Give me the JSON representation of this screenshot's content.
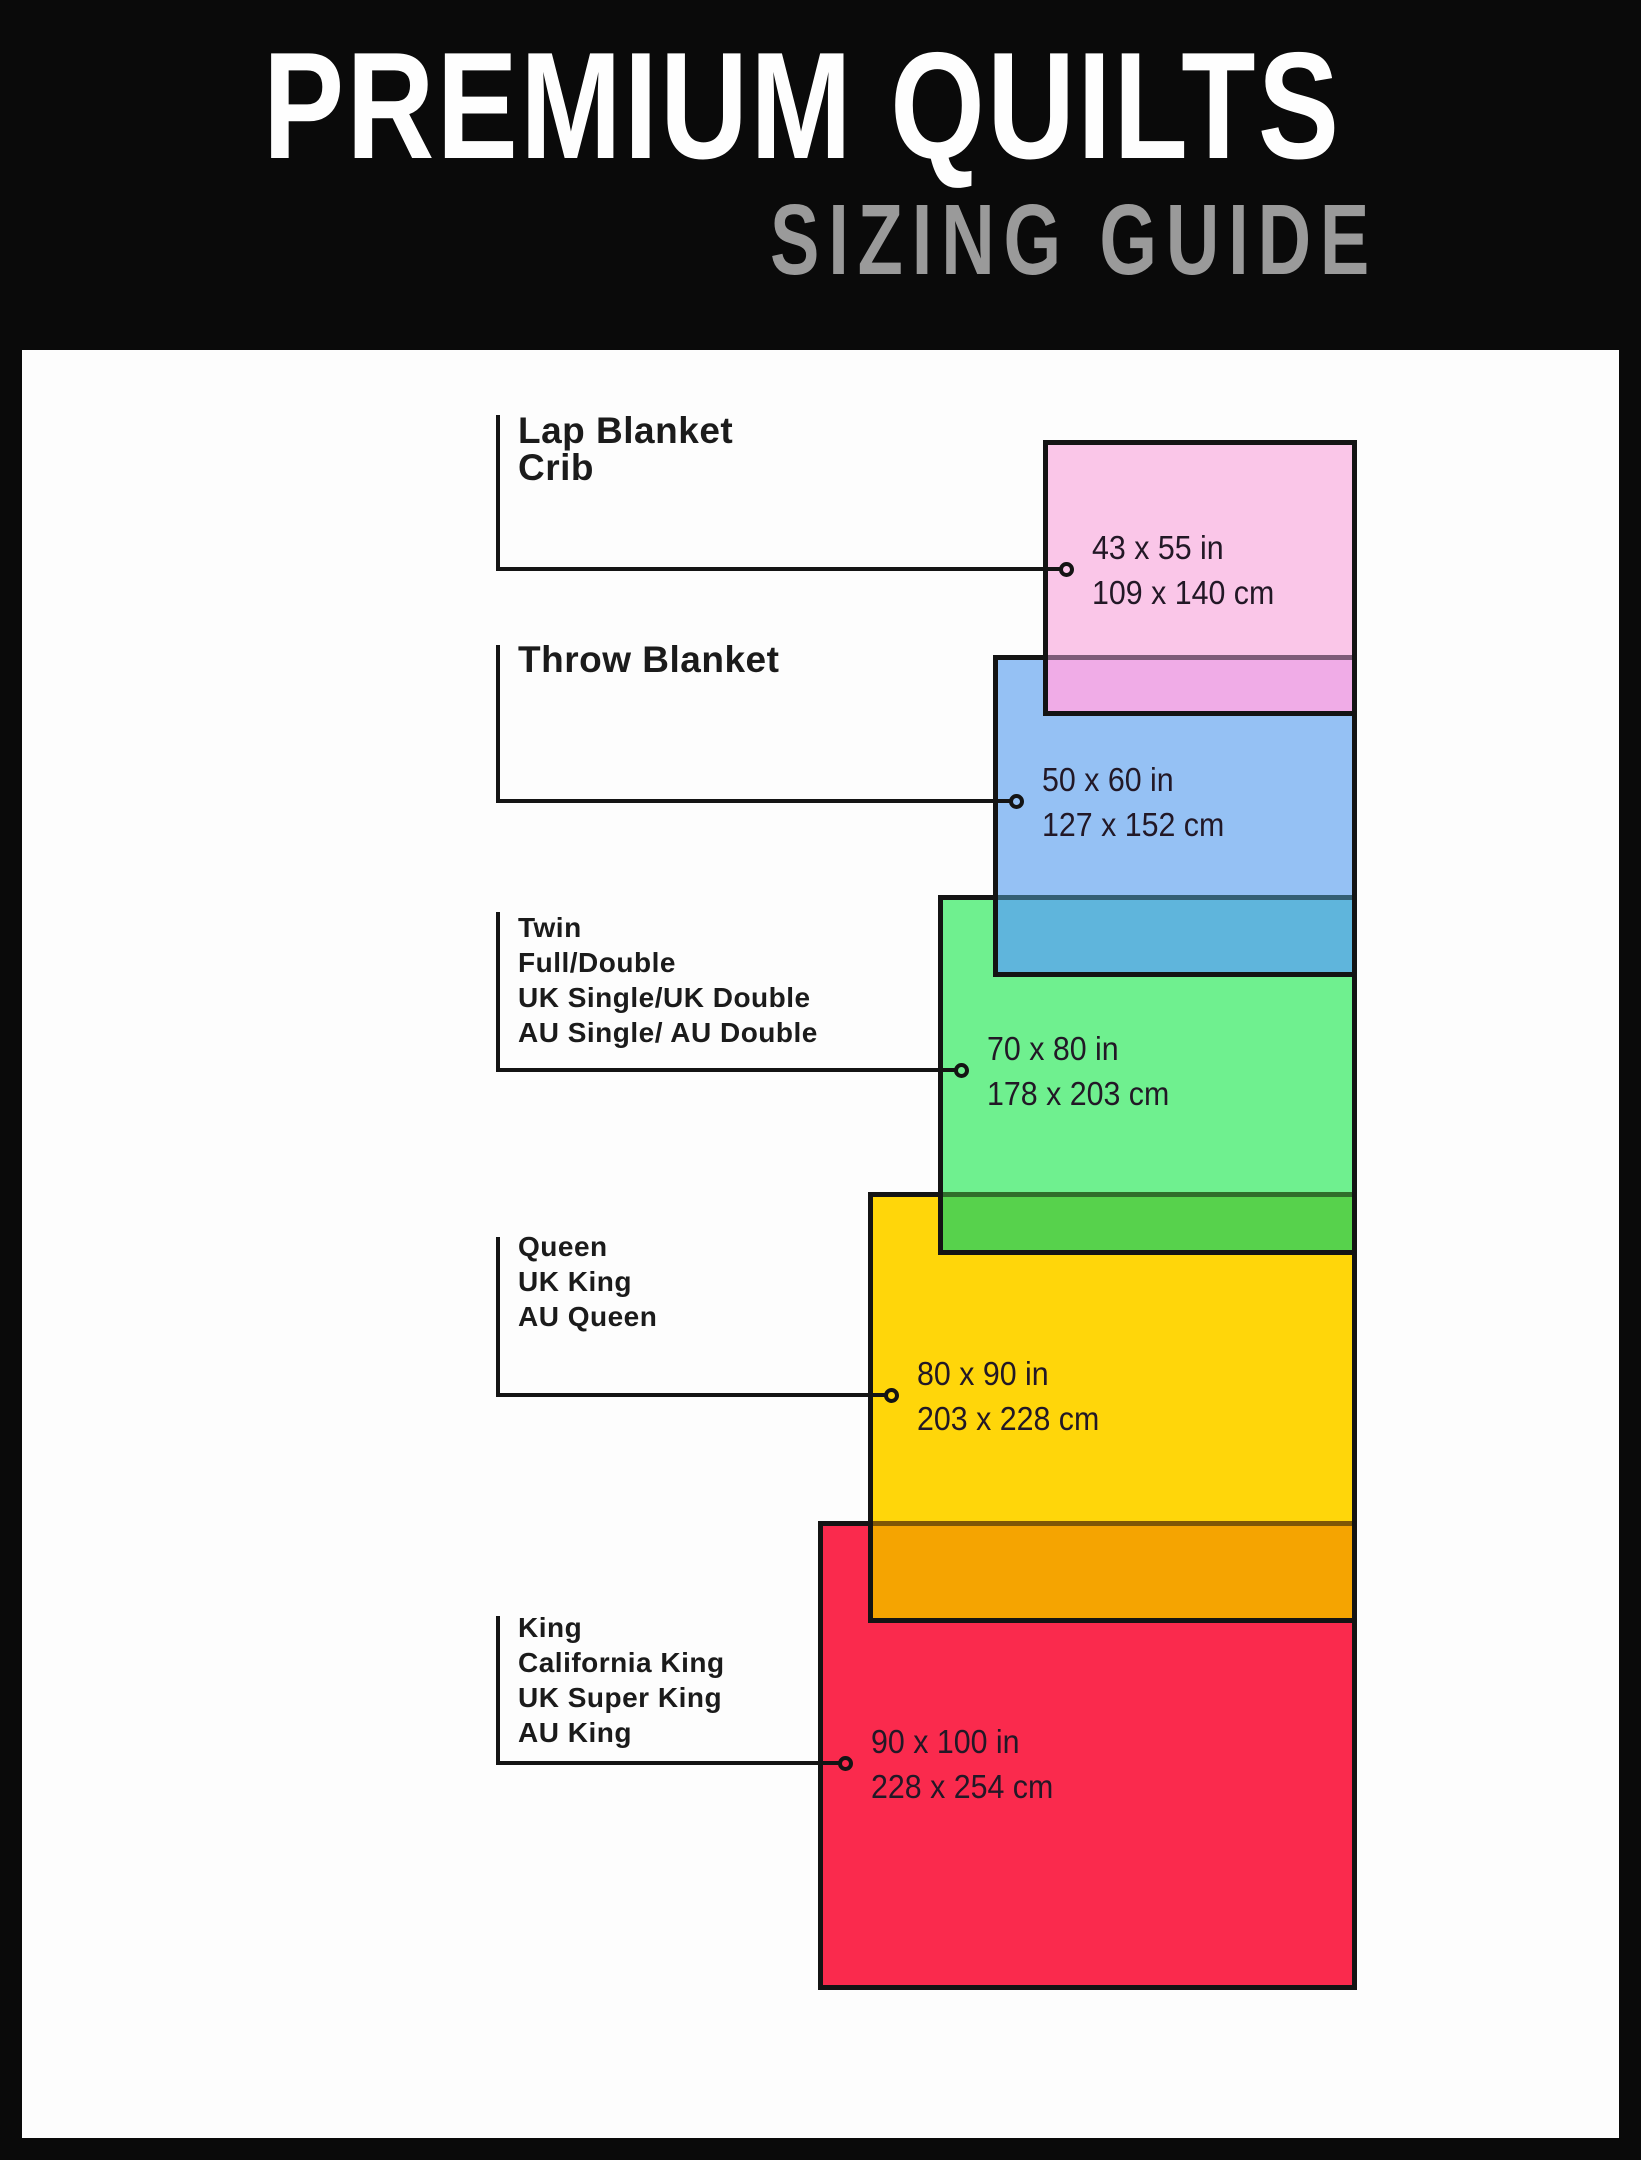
{
  "header": {
    "title": "PREMIUM QUILTS",
    "subtitle": "SIZING GUIDE",
    "background": "#0a0a0a",
    "title_color": "#fefefe",
    "subtitle_color": "#9a9a9a"
  },
  "quilts": [
    {
      "id": "lap-blanket-crib",
      "labels": [
        "Lap Blanket",
        "Crib"
      ],
      "size_in": "43 x 55 in",
      "size_cm": "109 x 140 cm",
      "width_in": 43,
      "height_in": 55,
      "width_cm": 109,
      "height_cm": 140,
      "color": "#fac6e8"
    },
    {
      "id": "throw-blanket",
      "labels": [
        "Throw Blanket"
      ],
      "size_in": "50 x 60 in",
      "size_cm": "127 x 152 cm",
      "width_in": 50,
      "height_in": 60,
      "width_cm": 127,
      "height_cm": 152,
      "color": "#95c1f4"
    },
    {
      "id": "twin-full-double",
      "labels": [
        "Twin",
        "Full/Double",
        "UK Single/UK Double",
        "AU Single/ AU Double"
      ],
      "size_in": "70 x 80 in",
      "size_cm": "178 x 203 cm",
      "width_in": 70,
      "height_in": 80,
      "width_cm": 178,
      "height_cm": 203,
      "color": "#6ff08f"
    },
    {
      "id": "queen",
      "labels": [
        "Queen",
        "UK King",
        "AU Queen"
      ],
      "size_in": "80 x 90 in",
      "size_cm": "203 x 228 cm",
      "width_in": 80,
      "height_in": 90,
      "width_cm": 203,
      "height_cm": 228,
      "color": "#ffd60a"
    },
    {
      "id": "king",
      "labels": [
        "King",
        "California King",
        "UK Super King",
        "AU King"
      ],
      "size_in": "90 x 100 in",
      "size_cm": "228 x 254 cm",
      "width_in": 90,
      "height_in": 100,
      "width_cm": 228,
      "height_cm": 254,
      "color": "#fa2a4d"
    }
  ],
  "overlap_colors": {
    "pink_over_blue": "#f0ace7",
    "blue_over_green": "#5fb5dc",
    "green_over_yellow": "#57d24c",
    "yellow_over_red": "#f5a401"
  },
  "line_color": "#141414",
  "label_color": "#1b1b1b",
  "paper_color": "#fdfdfd"
}
